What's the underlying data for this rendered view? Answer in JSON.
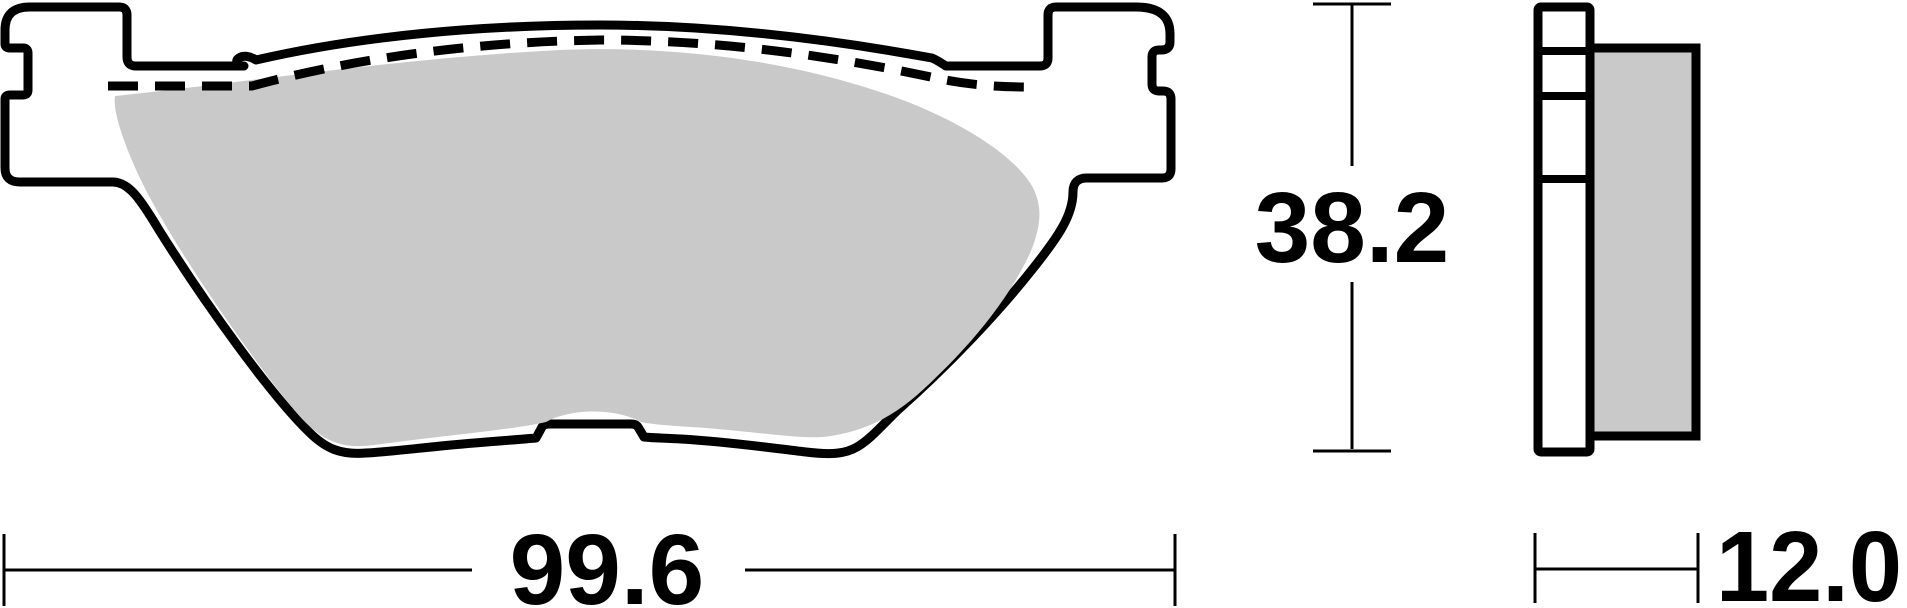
{
  "drawing": {
    "type": "brake-pad-technical-drawing",
    "dimensions": {
      "width": {
        "value": "99.6"
      },
      "height": {
        "value": "38.2"
      },
      "thickness": {
        "value": "12.0"
      }
    },
    "colors": {
      "outline": "#000000",
      "friction_material": "#c9c9c9",
      "background": "#ffffff",
      "dimension_lines": "#000000"
    }
  }
}
